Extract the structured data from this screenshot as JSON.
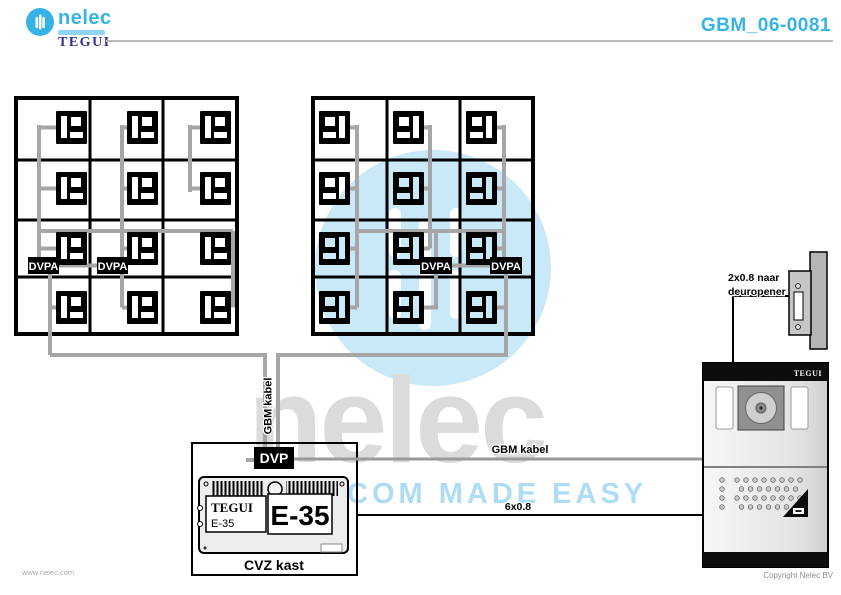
{
  "header": {
    "brand": "nelec",
    "sub_brand": "TEGUI",
    "doc_number": "GBM_06-0081"
  },
  "watermark": {
    "brand_text": "nelec",
    "tagline_text": "COM MADE EASY"
  },
  "diagram": {
    "dvpa_label": "DVPA",
    "dvp_label": "DVP",
    "riser_cable_label": "GBM kabel",
    "door_cable_label": "GBM kabel",
    "door_wire_label": "6x0.8",
    "opener_label_line1": "2x0.8 naar",
    "opener_label_line2": "deuropener",
    "cabinet_label": "CVZ kast",
    "unit_brand": "TEGUI",
    "unit_model_small": "E-35",
    "unit_model_large": "E-35",
    "panel_brand": "TEGUI"
  },
  "footer": {
    "website": "www.nelec.com",
    "copyright": "Copyright Nelec BV"
  },
  "colors": {
    "accent_blue": "#35b2e6",
    "tegui_navy": "#2e3192",
    "cable_gray": "#a6a6a6",
    "watermark_blue": "#c9e8f8",
    "watermark_gray": "#dbdbdb",
    "watermark_tagline_blue": "#aedcf5"
  }
}
